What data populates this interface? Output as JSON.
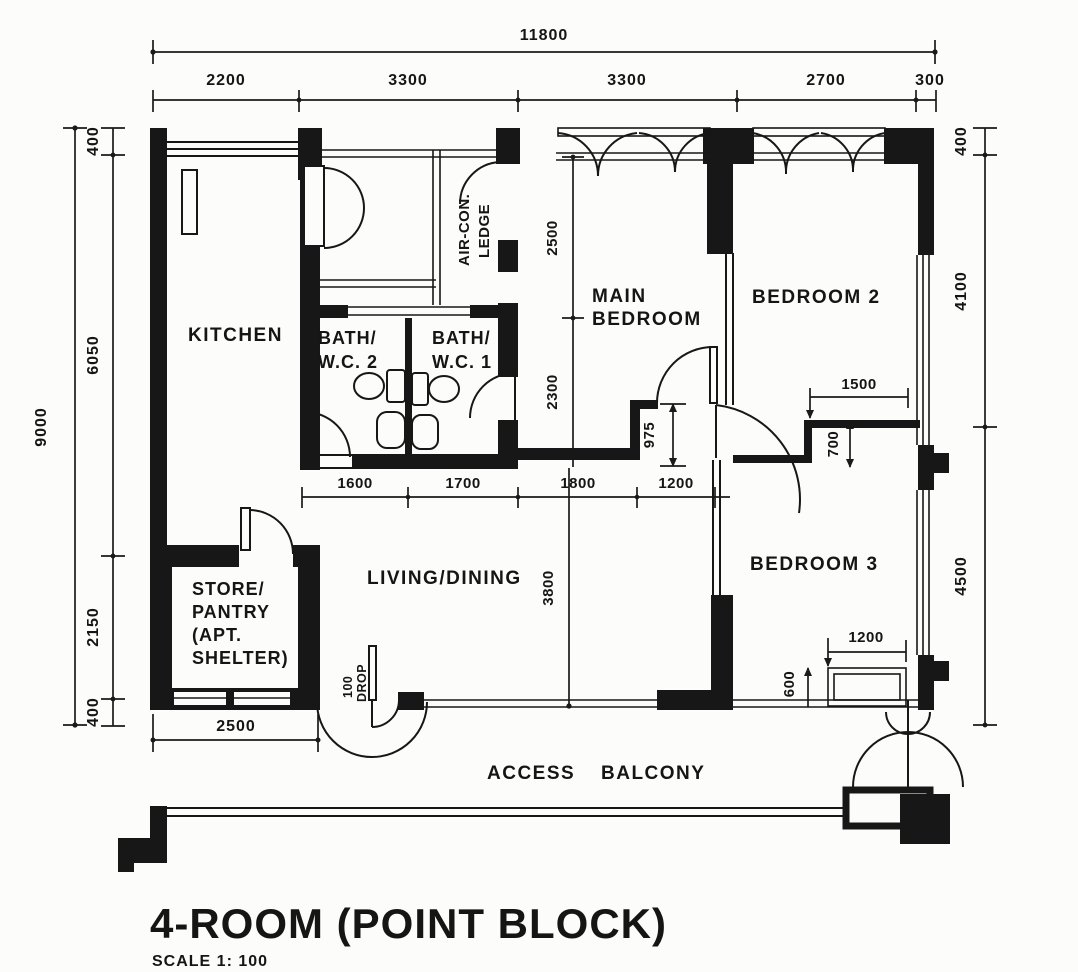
{
  "title": {
    "main": "4-ROOM (POINT BLOCK)",
    "scale": "SCALE 1: 100"
  },
  "rooms": {
    "kitchen": "KITCHEN",
    "bath2_l1": "BATH/",
    "bath2_l2": "W.C. 2",
    "bath1_l1": "BATH/",
    "bath1_l2": "W.C. 1",
    "aircon_l1": "AIR-CON.",
    "aircon_l2": "LEDGE",
    "main_bed_l1": "MAIN",
    "main_bed_l2": "BEDROOM",
    "bedroom2": "BEDROOM 2",
    "bedroom3": "BEDROOM 3",
    "living": "LIVING/DINING",
    "store_l1": "STORE/",
    "store_l2": "PANTRY",
    "store_l3": "(APT.",
    "store_l4": "SHELTER)",
    "balcony_w1": "ACCESS",
    "balcony_w2": "BALCONY"
  },
  "dims": {
    "overall_w": "11800",
    "top": [
      "2200",
      "3300",
      "3300",
      "2700",
      "300"
    ],
    "left_overall": "9000",
    "left": [
      "400",
      "6050",
      "2150",
      "400"
    ],
    "right": [
      "400",
      "4100",
      "4500"
    ],
    "row": [
      "1600",
      "1700",
      "1800",
      "1200"
    ],
    "mainbed": [
      "2500",
      "2300"
    ],
    "niche": "975",
    "bed2": [
      "1500",
      "700"
    ],
    "living_depth": "3800",
    "bed3": [
      "1200",
      "600"
    ],
    "store_w": "2500",
    "drop_l1": "100",
    "drop_l2": "DROP"
  }
}
